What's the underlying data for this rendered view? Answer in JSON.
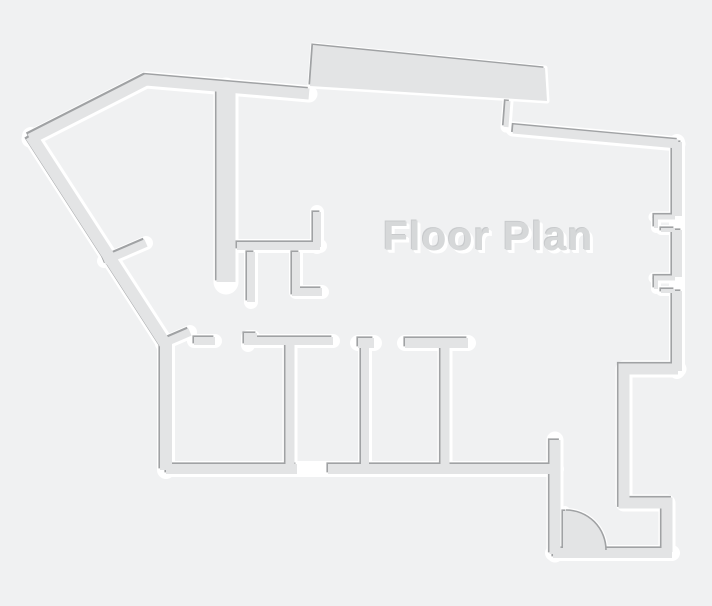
{
  "title": {
    "label": "Floor Plan"
  },
  "canvas": {
    "width": 712,
    "height": 606,
    "background": "#f0f1f2"
  },
  "palette": {
    "wall_fill": "#e3e4e5",
    "edge_shadow": "#a0a2a4",
    "casing": "#ffffff",
    "text_color": "#d6d8d9",
    "text_highlight": "#ffffff"
  },
  "floorplan": {
    "walls": [
      {
        "name": "exterior-wall-top-left",
        "pts": [
          [
            30,
            139
          ],
          [
            146,
            80
          ],
          [
            309,
            94
          ]
        ],
        "w": 11
      },
      {
        "name": "top-opening-jamb",
        "pts": [
          [
            508,
            101
          ],
          [
            506,
            127
          ]
        ],
        "w": 5
      },
      {
        "name": "exterior-wall-top-right",
        "pts": [
          [
            513,
            129
          ],
          [
            678,
            144
          ]
        ],
        "w": 9
      },
      {
        "name": "right-wall-casing",
        "pts": [
          [
            677,
            142
          ],
          [
            677,
            371
          ]
        ],
        "w": 10,
        "face": false
      },
      {
        "name": "right-wall-north",
        "pts": [
          [
            677,
            142
          ],
          [
            677,
            216
          ]
        ],
        "w": 10,
        "casing": false
      },
      {
        "name": "right-wall-middle",
        "pts": [
          [
            677,
            230
          ],
          [
            677,
            277
          ]
        ],
        "w": 10,
        "casing": false
      },
      {
        "name": "right-wall-south",
        "pts": [
          [
            677,
            291
          ],
          [
            677,
            371
          ]
        ],
        "w": 10,
        "casing": false
      },
      {
        "name": "right-notch1-top-stub",
        "pts": [
          [
            654,
            217
          ],
          [
            675,
            217
          ]
        ],
        "w": 5
      },
      {
        "name": "right-notch1-side-stub",
        "pts": [
          [
            656,
            218
          ],
          [
            656,
            228
          ]
        ],
        "w": 4
      },
      {
        "name": "right-notch1-bottom-stub",
        "pts": [
          [
            661,
            230
          ],
          [
            675,
            230
          ]
        ],
        "w": 4
      },
      {
        "name": "right-notch2-top-stub",
        "pts": [
          [
            654,
            278
          ],
          [
            675,
            278
          ]
        ],
        "w": 5
      },
      {
        "name": "right-notch2-side-stub",
        "pts": [
          [
            656,
            279
          ],
          [
            656,
            289
          ]
        ],
        "w": 4
      },
      {
        "name": "right-notch2-bottom-stub",
        "pts": [
          [
            661,
            291
          ],
          [
            675,
            291
          ]
        ],
        "w": 4
      },
      {
        "name": "exterior-wall-right-jog",
        "pts": [
          [
            678,
            369
          ],
          [
            624,
            369
          ],
          [
            624,
            503
          ],
          [
            667,
            503
          ],
          [
            667,
            552
          ]
        ],
        "w": 11
      },
      {
        "name": "exterior-wall-bottom-right",
        "pts": [
          [
            672,
            553
          ],
          [
            553,
            553
          ]
        ],
        "w": 10
      },
      {
        "name": "entry-jog-wall",
        "pts": [
          [
            555,
            440
          ],
          [
            555,
            554
          ]
        ],
        "w": 11
      },
      {
        "name": "bottom-wall-casing",
        "pts": [
          [
            166,
            469
          ],
          [
            556,
            469
          ]
        ],
        "w": 10,
        "face": false
      },
      {
        "name": "bottom-wall-west",
        "pts": [
          [
            166,
            469
          ],
          [
            297,
            469
          ]
        ],
        "w": 10,
        "casing": false
      },
      {
        "name": "bottom-wall-east",
        "pts": [
          [
            328,
            469
          ],
          [
            556,
            469
          ]
        ],
        "w": 10,
        "casing": false
      },
      {
        "name": "exterior-wall-left",
        "pts": [
          [
            31,
            136
          ],
          [
            166,
            345
          ],
          [
            166,
            470
          ]
        ],
        "w": 12
      },
      {
        "name": "interior-thick-wall-center",
        "pts": [
          [
            226,
            90
          ],
          [
            226,
            282
          ]
        ],
        "w": 19
      },
      {
        "name": "room1-wall-horizontal",
        "pts": [
          [
            237,
            246
          ],
          [
            320,
            246
          ]
        ],
        "w": 8
      },
      {
        "name": "room1-stub-up",
        "pts": [
          [
            317,
            212
          ],
          [
            317,
            247
          ]
        ],
        "w": 8
      },
      {
        "name": "room1-stub-down-a",
        "pts": [
          [
            251,
            252
          ],
          [
            251,
            302
          ]
        ],
        "w": 8
      },
      {
        "name": "room1-stub-down-b",
        "pts": [
          [
            296,
            252
          ],
          [
            296,
            292
          ],
          [
            322,
            292
          ]
        ],
        "w": 8
      },
      {
        "name": "left-diagonal-stub",
        "pts": [
          [
            104,
            261
          ],
          [
            146,
            243
          ]
        ],
        "w": 8
      },
      {
        "name": "corner-diagonal-stub",
        "pts": [
          [
            162,
            344
          ],
          [
            190,
            332
          ]
        ],
        "w": 8
      },
      {
        "name": "mid-wall-a",
        "pts": [
          [
            194,
            341
          ],
          [
            215,
            341
          ]
        ],
        "w": 8
      },
      {
        "name": "mid-wall-b-step",
        "pts": [
          [
            248,
            345
          ],
          [
            248,
            337
          ],
          [
            253,
            337
          ],
          [
            253,
            341
          ],
          [
            333,
            341
          ]
        ],
        "w": 8
      },
      {
        "name": "mid-wall-c-cap",
        "pts": [
          [
            358,
            343
          ],
          [
            374,
            343
          ]
        ],
        "w": 10
      },
      {
        "name": "room2-wall-vertical",
        "pts": [
          [
            365,
            346
          ],
          [
            365,
            465
          ]
        ],
        "w": 8
      },
      {
        "name": "t-wall-bar",
        "pts": [
          [
            405,
            343
          ],
          [
            468,
            343
          ]
        ],
        "w": 10
      },
      {
        "name": "t-wall-stem",
        "pts": [
          [
            445,
            346
          ],
          [
            445,
            465
          ]
        ],
        "w": 9
      },
      {
        "name": "room3-wall-vertical",
        "pts": [
          [
            290,
            344
          ],
          [
            290,
            465
          ]
        ],
        "w": 9
      },
      {
        "name": "door-leaf",
        "pts": [
          [
            565,
            511
          ],
          [
            565,
            549
          ]
        ],
        "w": 4
      }
    ],
    "slabs": [
      {
        "name": "top-bump-slab",
        "pts": [
          [
            310,
            86
          ],
          [
            313,
            45
          ],
          [
            545,
            68
          ],
          [
            547,
            101
          ]
        ]
      }
    ],
    "door": {
      "cx": 566,
      "cy": 550,
      "r": 40
    },
    "shadow_offset": -1.6,
    "casing_extra": 6
  }
}
